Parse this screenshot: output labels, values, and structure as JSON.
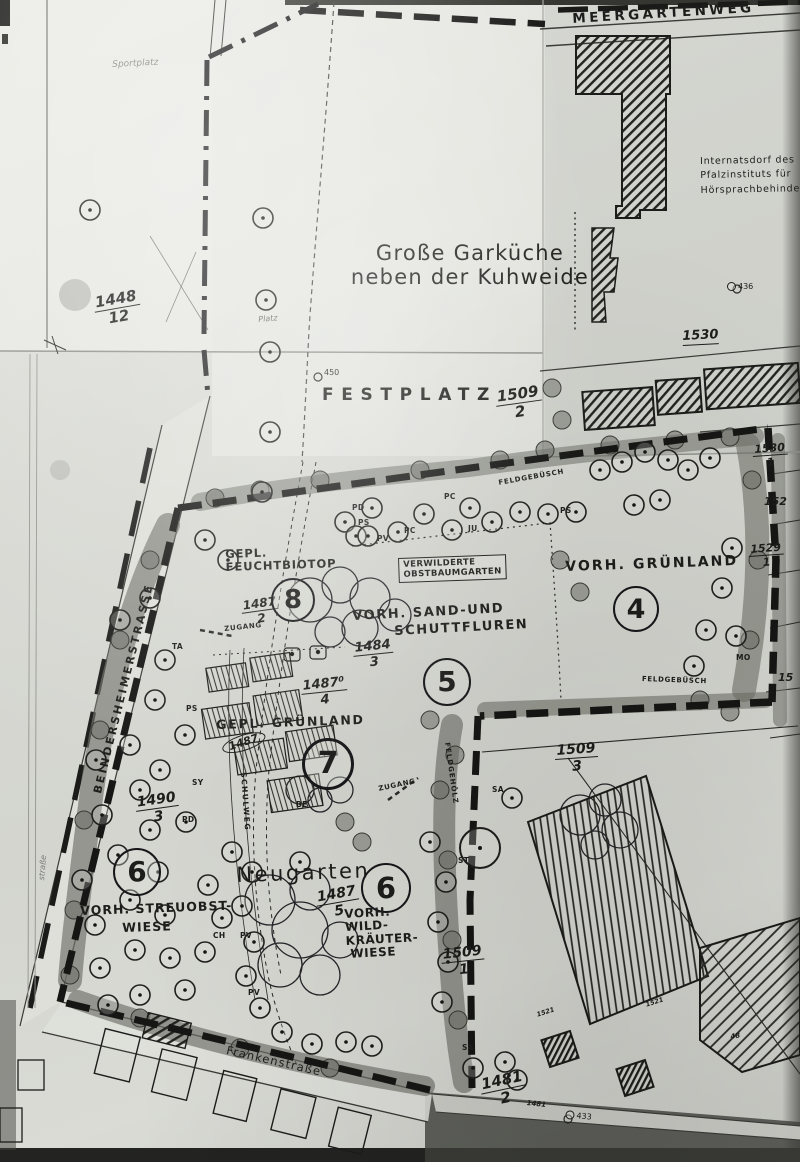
{
  "colors": {
    "paper": "#d9dad4",
    "ink": "#1d1d1b",
    "hedge_gray": "#6e6f68",
    "scan_edge": "#8a8b86"
  },
  "streets": {
    "meergartenweg": "MEERGARTENWEG",
    "beindersheimer": "BEINDERSHEIMERSTRASSE",
    "frankenstrasse": "Frankenstraße",
    "side_street": "straße",
    "schulweg": "SCHULWEG"
  },
  "titles": {
    "garkueche_line1": "Große Garküche",
    "garkueche_line2": "neben der Kuhweide",
    "festplatz": "FESTPLATZ",
    "sportplatz": "Sportplatz",
    "platz": "Platz",
    "neugarten": "Neugarten"
  },
  "institution": {
    "line1": "Internatsdorf des",
    "line2": "Pfalzinstituts für",
    "line3": "Hörsprachbehinderte"
  },
  "areas": {
    "feuchtbiotop_line1": "GEPL.",
    "feuchtbiotop_line2": "FEUCHTBIOTOP",
    "verwilderte_line1": "VERWILDERTE",
    "verwilderte_line2": "OBSTBAUMGARTEN",
    "sand_line1": "VORH. SAND-UND",
    "sand_line2": "SCHUTTFLUREN",
    "gruenland_vorh": "VORH. GRÜNLAND",
    "gruenland_gepl": "GEPL. GRÜNLAND",
    "streuobst_line1": "VORH. STREUOBST-",
    "streuobst_line2": "WIESE",
    "wild_line1": "VORH.",
    "wild_line2": "WILD-",
    "wild_line3": "KRÄUTER-",
    "wild_line4": "WIESE"
  },
  "area_numbers": {
    "n4": "4",
    "n5": "5",
    "n6a": "6",
    "n6b": "6",
    "n7": "7",
    "n8": "8"
  },
  "annotations": {
    "zugang": "ZUGANG",
    "feldgebuesch": "FELDGEBÜSCH",
    "feldgehoelz": "FELDGEHÖLZ"
  },
  "parcels": {
    "p1448": {
      "num": "1448",
      "den": "12"
    },
    "p1509_2": {
      "num": "1509",
      "den": "2"
    },
    "p1509_3": {
      "num": "1509",
      "den": "3"
    },
    "p1509_1": {
      "num": "1509",
      "den": "1"
    },
    "p1487_2": {
      "num": "1487",
      "den": "2"
    },
    "p1487b_4": {
      "num": "1487⁰",
      "den": "4"
    },
    "p1487_5": {
      "num": "1487",
      "den": "5"
    },
    "p1484_3": {
      "num": "1484",
      "den": "3"
    },
    "p1490_3": {
      "num": "1490",
      "den": "3"
    },
    "p1481_2": {
      "num": "1481",
      "den": "2"
    },
    "p1530_1": {
      "num": "1530",
      "den": "1"
    },
    "p1529_1": {
      "num": "1529",
      "den": "1"
    },
    "p1530": "1530",
    "p152": "152",
    "p15": "15",
    "p1487_oval": "1487",
    "p1521": "1521",
    "p48": "48",
    "road_1481": "1481"
  },
  "markers": {
    "m450": "450",
    "m436": "436",
    "m433": "433"
  },
  "species": {
    "pd1": "PD",
    "ps1": "PS",
    "pv1": "PV",
    "pc1": "PC",
    "pc2": "PC",
    "ju1": "JU",
    "ps2": "PS",
    "ta1": "TA",
    "ps3": "PS",
    "sy1": "SY",
    "pd2": "PD",
    "be1": "BE",
    "ch1": "CH",
    "pv2": "PV",
    "pv3": "PV",
    "sa1": "SA",
    "st1": "ST",
    "sa2": "SA",
    "mo1": "MO"
  }
}
